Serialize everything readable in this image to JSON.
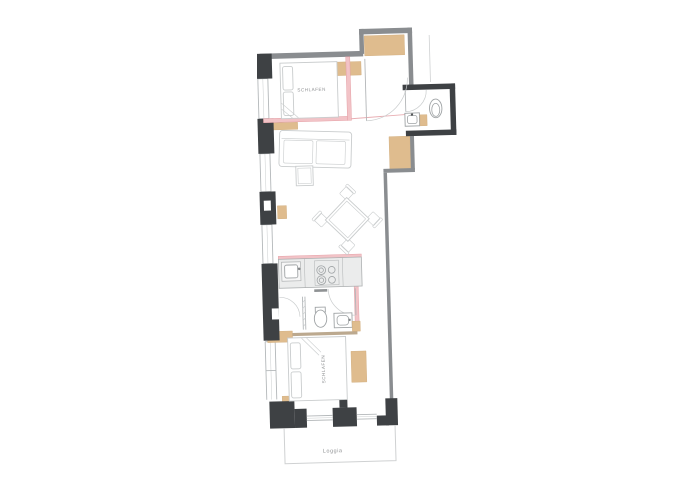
{
  "page": {
    "background": "#ffffff"
  },
  "plan": {
    "type": "apartment-floor-plan",
    "labels": {
      "bedroom_top": "SCHLAFEN",
      "bedroom_bottom": "SCHLAFEN",
      "loggia": "Loggia"
    },
    "palette": {
      "wall_dark": "#3e4144",
      "wall_medium": "#8a8d90",
      "wood": "#dfbc8e",
      "wood_border": "#cfa978",
      "wall_beam": "#bca98f",
      "partition_pink": "#f2c3c7",
      "partition_pink_dark": "#e5a0a6",
      "furniture_line": "#c9cccd",
      "fixture_line": "#9fa3a5",
      "window_line": "#b4b8ba",
      "counter_fill": "#ebecec",
      "counter_line": "#aeb1b2",
      "loggia_line": "#cfd1d2",
      "label_text": "#8f9193",
      "handle_dark": "#8f9294"
    },
    "fixtures": [
      "bed-top-bedroom",
      "bed-bottom-bedroom",
      "sofa",
      "coffee-table",
      "dining-table-with-4-chairs",
      "kitchen-counter-with-sink-and-stove",
      "bathroom-shower-toilet-washbasin",
      "wc-toilet-washbasin",
      "wardrobes",
      "loggia"
    ]
  }
}
